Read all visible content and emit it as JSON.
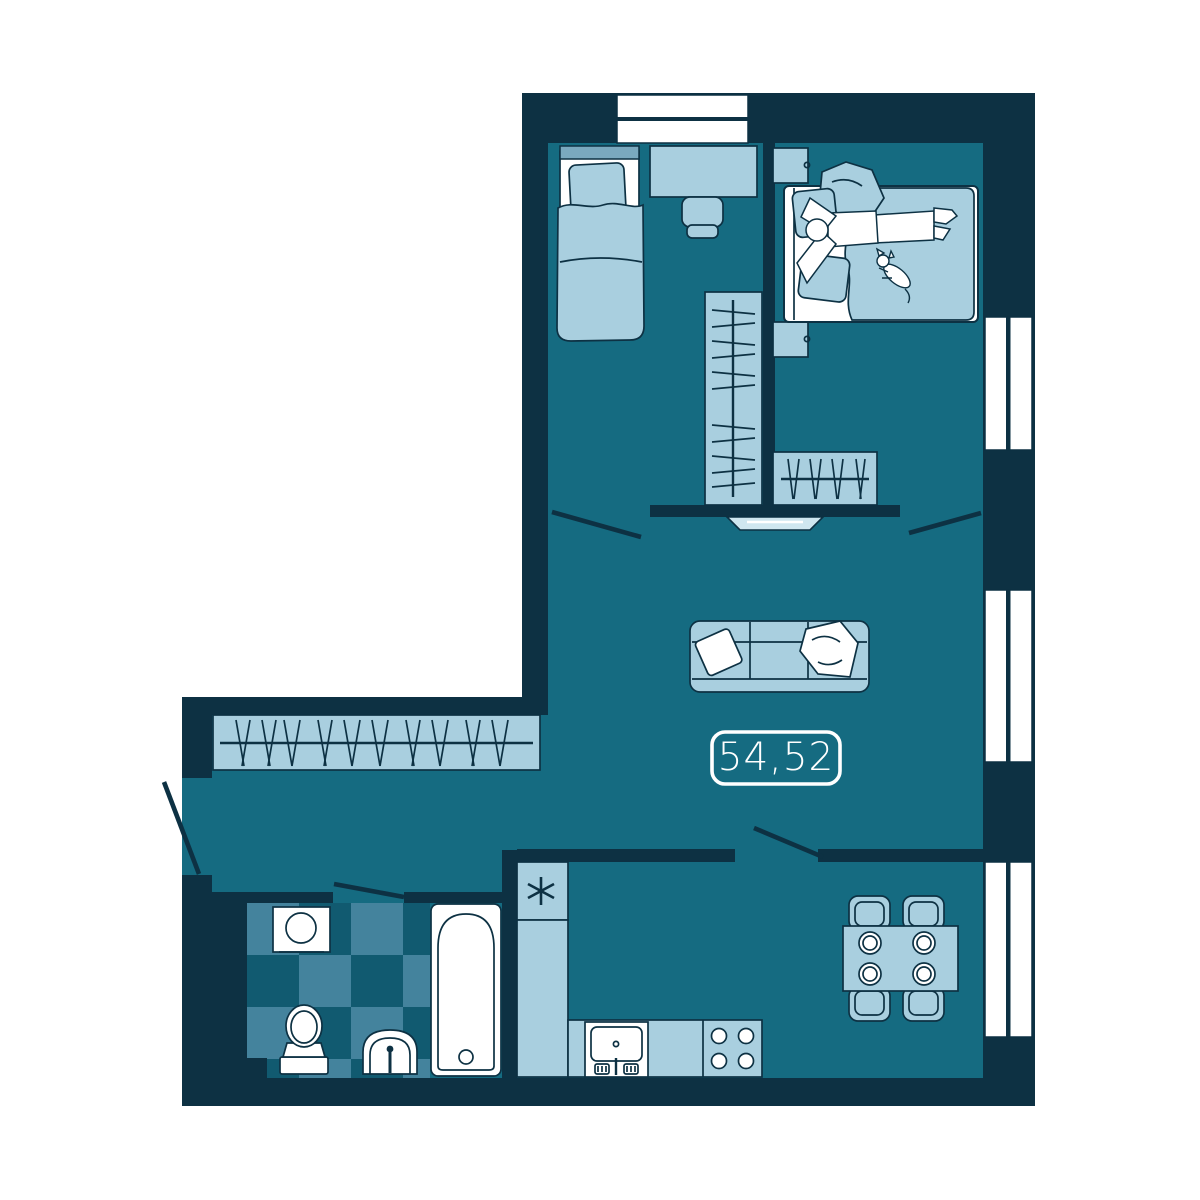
{
  "title": "Apartment floor plan",
  "area_label": {
    "value": "54,52",
    "unit_implied": "m2"
  },
  "kitchen": {
    "fridge_symbol": "*",
    "fridge_symbol_icon": "asterisk-icon"
  },
  "colors": {
    "background": "#ffffff",
    "wall": "#0d3143",
    "floor": "#156b81",
    "furniture_light": "#a9cfdf",
    "furniture_pale": "#cfe7f0",
    "accent_mid": "#7aa9bf",
    "tile_light": "#44839d",
    "tile_dark": "#115a70",
    "white": "#ffffff"
  }
}
